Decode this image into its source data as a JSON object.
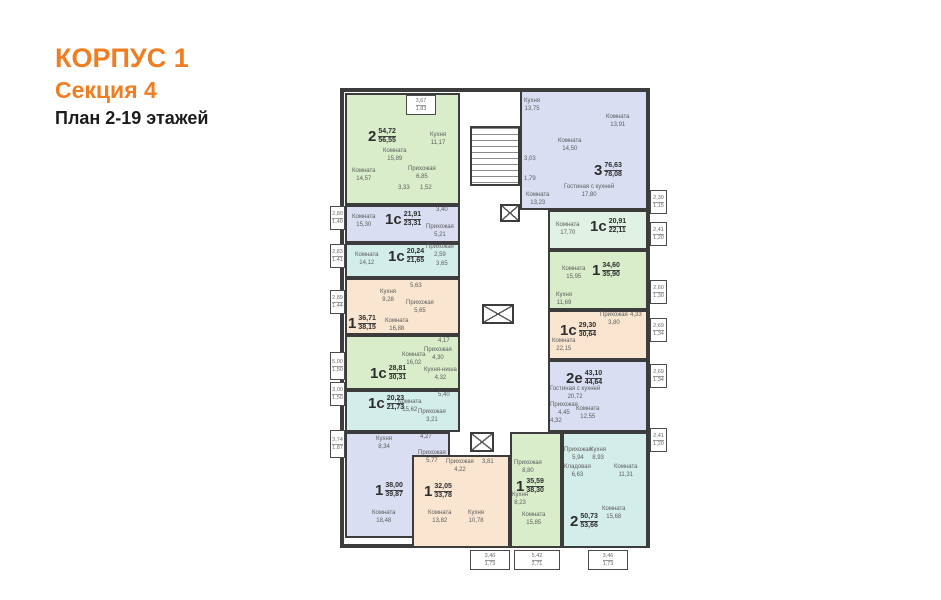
{
  "header": {
    "title": "КОРПУС 1",
    "subtitle": "Секция 4",
    "caption": "План 2-19 этажей"
  },
  "colors": {
    "accent": "#EF7E23",
    "wall": "#3C3C3C",
    "green": "#D9EDCB",
    "lavender": "#D9DEF2",
    "teal": "#D3EDEA",
    "mint": "#DFF2E3",
    "peach": "#F9E5D0"
  },
  "plan": {
    "building": {
      "x": 340,
      "y": 88,
      "w": 310,
      "h": 460
    },
    "apartments": [
      {
        "id": "a1",
        "type": "2",
        "a1": "54,72",
        "a2": "56,55",
        "color": "green",
        "box": [
          345,
          93,
          115,
          112
        ],
        "label": [
          368,
          128
        ],
        "rooms": [
          {
            "n": "Комната",
            "v": "15,89",
            "x": 383,
            "y": 148
          },
          {
            "n": "Кухня",
            "v": "11,17",
            "x": 430,
            "y": 132
          },
          {
            "n": "Комната",
            "v": "14,57",
            "x": 352,
            "y": 168
          },
          {
            "n": "Прихожая",
            "v": "6,85",
            "x": 408,
            "y": 166
          },
          {
            "n": "",
            "v": "3,33",
            "x": 398,
            "y": 185
          },
          {
            "n": "",
            "v": "1,52",
            "x": 420,
            "y": 185
          }
        ]
      },
      {
        "id": "a2",
        "type": "1с",
        "a1": "21,91",
        "a2": "23,31",
        "color": "lavender",
        "box": [
          345,
          205,
          115,
          38
        ],
        "label": [
          385,
          211
        ],
        "rooms": [
          {
            "n": "Комната",
            "v": "15,30",
            "x": 352,
            "y": 214
          },
          {
            "n": "",
            "v": "3,40",
            "x": 436,
            "y": 207
          },
          {
            "n": "Прихожая",
            "v": "5,21",
            "x": 426,
            "y": 224
          }
        ]
      },
      {
        "id": "a3",
        "type": "1с",
        "a1": "20,24",
        "a2": "21,65",
        "color": "teal",
        "box": [
          345,
          243,
          115,
          35
        ],
        "label": [
          388,
          248
        ],
        "rooms": [
          {
            "n": "Комната",
            "v": "14,12",
            "x": 355,
            "y": 252
          },
          {
            "n": "Прихожая",
            "v": "2,59",
            "x": 426,
            "y": 244
          },
          {
            "n": "",
            "v": "3,65",
            "x": 436,
            "y": 261
          }
        ]
      },
      {
        "id": "a4",
        "type": "1",
        "a1": "36,71",
        "a2": "38,15",
        "color": "peach",
        "box": [
          345,
          278,
          115,
          57
        ],
        "label": [
          348,
          315
        ],
        "rooms": [
          {
            "n": "Кухня",
            "v": "9,28",
            "x": 380,
            "y": 289
          },
          {
            "n": "",
            "v": "5,63",
            "x": 410,
            "y": 283
          },
          {
            "n": "Прихожая",
            "v": "5,65",
            "x": 406,
            "y": 300
          },
          {
            "n": "Комната",
            "v": "16,88",
            "x": 385,
            "y": 318
          }
        ]
      },
      {
        "id": "a5",
        "type": "1с",
        "a1": "28,81",
        "a2": "30,31",
        "color": "green",
        "box": [
          345,
          335,
          115,
          55
        ],
        "label": [
          370,
          365
        ],
        "rooms": [
          {
            "n": "",
            "v": "4,17",
            "x": 438,
            "y": 338
          },
          {
            "n": "Прихожая",
            "v": "4,30",
            "x": 424,
            "y": 347
          },
          {
            "n": "Комната",
            "v": "16,02",
            "x": 402,
            "y": 352
          },
          {
            "n": "Кухня-ниша",
            "v": "4,32",
            "x": 424,
            "y": 367
          }
        ]
      },
      {
        "id": "a6",
        "type": "1с",
        "a1": "20,23",
        "a2": "21,73",
        "color": "teal",
        "box": [
          345,
          390,
          115,
          42
        ],
        "label": [
          368,
          395
        ],
        "rooms": [
          {
            "n": "Комната",
            "v": "15,62",
            "x": 398,
            "y": 399
          },
          {
            "n": "",
            "v": "5,40",
            "x": 438,
            "y": 392
          },
          {
            "n": "Прихожая",
            "v": "3,21",
            "x": 418,
            "y": 409
          }
        ]
      },
      {
        "id": "a7",
        "type": "1",
        "a1": "38,00",
        "a2": "39,87",
        "color": "lavender",
        "box": [
          345,
          432,
          105,
          106
        ],
        "label": [
          375,
          482
        ],
        "rooms": [
          {
            "n": "Кухня",
            "v": "8,34",
            "x": 376,
            "y": 436
          },
          {
            "n": "",
            "v": "4,27",
            "x": 420,
            "y": 434
          },
          {
            "n": "Прихожая",
            "v": "5,77",
            "x": 418,
            "y": 450
          },
          {
            "n": "Комната",
            "v": "18,48",
            "x": 372,
            "y": 510
          }
        ]
      },
      {
        "id": "a8",
        "type": "1",
        "a1": "32,05",
        "a2": "33,78",
        "color": "peach",
        "box": [
          412,
          455,
          98,
          93
        ],
        "label": [
          424,
          483
        ],
        "rooms": [
          {
            "n": "Прихожая",
            "v": "4,22",
            "x": 446,
            "y": 459
          },
          {
            "n": "",
            "v": "3,81",
            "x": 482,
            "y": 459
          },
          {
            "n": "Комната",
            "v": "13,82",
            "x": 428,
            "y": 510
          },
          {
            "n": "Кухня",
            "v": "10,78",
            "x": 468,
            "y": 510
          }
        ]
      },
      {
        "id": "a9",
        "type": "1",
        "a1": "35,59",
        "a2": "38,30",
        "color": "green",
        "box": [
          510,
          432,
          52,
          116
        ],
        "label": [
          516,
          478
        ],
        "rooms": [
          {
            "n": "Прихожая",
            "v": "8,80",
            "x": 514,
            "y": 460
          },
          {
            "n": "Кухня",
            "v": "8,23",
            "x": 512,
            "y": 492
          },
          {
            "n": "Комната",
            "v": "15,85",
            "x": 522,
            "y": 512
          }
        ]
      },
      {
        "id": "a10",
        "type": "2",
        "a1": "50,73",
        "a2": "53,66",
        "color": "teal",
        "box": [
          562,
          432,
          86,
          116
        ],
        "label": [
          570,
          513
        ],
        "rooms": [
          {
            "n": "Прихожая",
            "v": "5,94",
            "x": 564,
            "y": 447
          },
          {
            "n": "Кладовая",
            "v": "6,63",
            "x": 564,
            "y": 464
          },
          {
            "n": "Кухня",
            "v": "8,93",
            "x": 590,
            "y": 447
          },
          {
            "n": "Комната",
            "v": "11,31",
            "x": 614,
            "y": 464
          },
          {
            "n": "Комната",
            "v": "15,68",
            "x": 602,
            "y": 506
          }
        ]
      },
      {
        "id": "b1",
        "type": "3",
        "a1": "76,63",
        "a2": "78,08",
        "color": "lavender",
        "box": [
          520,
          90,
          128,
          120
        ],
        "label": [
          594,
          162
        ],
        "rooms": [
          {
            "n": "Кухня",
            "v": "13,75",
            "x": 524,
            "y": 98
          },
          {
            "n": "Комната",
            "v": "14,50",
            "x": 558,
            "y": 138
          },
          {
            "n": "Комната",
            "v": "13,91",
            "x": 606,
            "y": 114
          },
          {
            "n": "",
            "v": "3,03",
            "x": 524,
            "y": 156
          },
          {
            "n": "",
            "v": "1,79",
            "x": 524,
            "y": 176
          },
          {
            "n": "Гостиная с кухней",
            "v": "17,80",
            "x": 564,
            "y": 184
          },
          {
            "n": "Комната",
            "v": "13,23",
            "x": 526,
            "y": 192
          }
        ]
      },
      {
        "id": "b2",
        "type": "1с",
        "a1": "20,91",
        "a2": "22,11",
        "color": "mint",
        "box": [
          548,
          210,
          100,
          40
        ],
        "label": [
          590,
          218
        ],
        "rooms": [
          {
            "n": "Комната",
            "v": "17,70",
            "x": 556,
            "y": 222
          }
        ]
      },
      {
        "id": "b3",
        "type": "1",
        "a1": "34,60",
        "a2": "35,90",
        "color": "green",
        "box": [
          548,
          250,
          100,
          60
        ],
        "label": [
          592,
          262
        ],
        "rooms": [
          {
            "n": "Комната",
            "v": "15,95",
            "x": 562,
            "y": 266
          },
          {
            "n": "Кухня",
            "v": "11,69",
            "x": 556,
            "y": 292
          }
        ]
      },
      {
        "id": "b4",
        "type": "1с",
        "a1": "29,30",
        "a2": "30,64",
        "color": "peach",
        "box": [
          548,
          310,
          100,
          50
        ],
        "label": [
          560,
          322
        ],
        "rooms": [
          {
            "n": "Прихожая",
            "v": "3,80",
            "x": 600,
            "y": 312
          },
          {
            "n": "",
            "v": "4,33",
            "x": 630,
            "y": 312
          },
          {
            "n": "Комната",
            "v": "22,15",
            "x": 552,
            "y": 338
          }
        ]
      },
      {
        "id": "b5",
        "type": "2е",
        "a1": "43,10",
        "a2": "44,64",
        "color": "lavender",
        "box": [
          548,
          360,
          100,
          72
        ],
        "label": [
          566,
          370
        ],
        "rooms": [
          {
            "n": "Гостиная с кухней",
            "v": "20,72",
            "x": 550,
            "y": 386
          },
          {
            "n": "Прихожая",
            "v": "4,45",
            "x": 550,
            "y": 402
          },
          {
            "n": "Комната",
            "v": "12,55",
            "x": 576,
            "y": 406
          },
          {
            "n": "",
            "v": "4,32",
            "x": 550,
            "y": 418
          }
        ]
      }
    ],
    "core": {
      "stairs": [
        470,
        126,
        50,
        60
      ],
      "elevators": [
        [
          500,
          204,
          20,
          18
        ],
        [
          482,
          304,
          32,
          20
        ],
        [
          470,
          432,
          24,
          20
        ]
      ]
    },
    "balconies": [
      {
        "v1": "3,67",
        "v2": "1,83",
        "x": 406,
        "y": 95,
        "w": 30,
        "h": 20
      },
      {
        "v1": "2,80",
        "v2": "1,40",
        "x": 330,
        "y": 206,
        "w": 15,
        "h": 24
      },
      {
        "v1": "2,83",
        "v2": "1,41",
        "x": 330,
        "y": 244,
        "w": 15,
        "h": 24
      },
      {
        "v1": "2,89",
        "v2": "1,44",
        "x": 330,
        "y": 290,
        "w": 15,
        "h": 24
      },
      {
        "v1": "5,00",
        "v2": "1,50",
        "x": 330,
        "y": 352,
        "w": 15,
        "h": 28
      },
      {
        "v1": "3,00",
        "v2": "1,50",
        "x": 330,
        "y": 382,
        "w": 15,
        "h": 24
      },
      {
        "v1": "3,74",
        "v2": "1,87",
        "x": 330,
        "y": 430,
        "w": 15,
        "h": 28
      },
      {
        "v1": "2,30",
        "v2": "1,15",
        "x": 650,
        "y": 190,
        "w": 17,
        "h": 24
      },
      {
        "v1": "2,41",
        "v2": "1,20",
        "x": 650,
        "y": 222,
        "w": 17,
        "h": 24
      },
      {
        "v1": "2,60",
        "v2": "1,30",
        "x": 650,
        "y": 280,
        "w": 17,
        "h": 24
      },
      {
        "v1": "2,69",
        "v2": "1,34",
        "x": 650,
        "y": 318,
        "w": 17,
        "h": 24
      },
      {
        "v1": "2,69",
        "v2": "1,34",
        "x": 650,
        "y": 364,
        "w": 17,
        "h": 24
      },
      {
        "v1": "2,41",
        "v2": "1,20",
        "x": 650,
        "y": 428,
        "w": 17,
        "h": 24
      },
      {
        "v1": "3,46",
        "v2": "1,73",
        "x": 470,
        "y": 550,
        "w": 40,
        "h": 20
      },
      {
        "v1": "5,42",
        "v2": "2,71",
        "x": 514,
        "y": 550,
        "w": 46,
        "h": 20
      },
      {
        "v1": "3,46",
        "v2": "1,73",
        "x": 588,
        "y": 550,
        "w": 40,
        "h": 20
      }
    ]
  }
}
